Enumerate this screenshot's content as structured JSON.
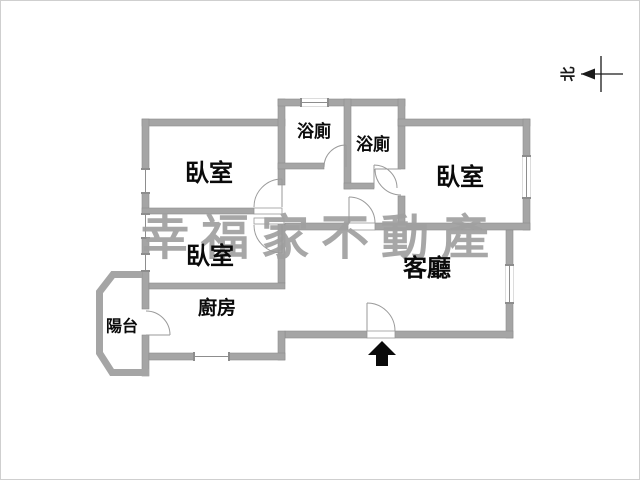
{
  "title": "apartment-floor-plan",
  "watermark": {
    "text": "幸福家不動產"
  },
  "north_indicator": {
    "label": "北"
  },
  "rooms": [
    {
      "id": "bedroom-1",
      "label": "臥室"
    },
    {
      "id": "bedroom-2",
      "label": "臥室"
    },
    {
      "id": "bedroom-3",
      "label": "臥室"
    },
    {
      "id": "bathroom-1",
      "label": "浴廁"
    },
    {
      "id": "bathroom-2",
      "label": "浴廁"
    },
    {
      "id": "living-room",
      "label": "客廳"
    },
    {
      "id": "kitchen",
      "label": "廚房"
    },
    {
      "id": "balcony",
      "label": "陽台"
    }
  ],
  "colors": {
    "wall": "#a5a5a5",
    "wall_edge": "#8d8d8d",
    "door_line": "#9a9a9a",
    "label": "#0a0a0a",
    "watermark": "#a0a0a0",
    "frame": "#cfcfcf",
    "entrance_arrow": "#0a0a0a"
  }
}
